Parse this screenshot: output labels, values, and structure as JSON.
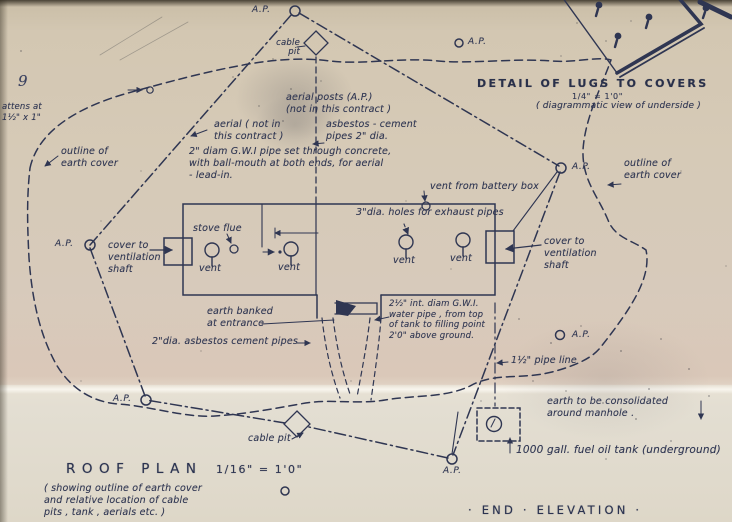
{
  "drawing": {
    "page_number": "9",
    "title": "ROOF  PLAN",
    "scale": "1/16\" = 1'0\"",
    "subtitle": "( showing outline of earth cover\nand relative location of cable\npits , tank , aerials etc. )",
    "end_elevation": "· END · ELEVATION ·"
  },
  "detail": {
    "title": "DETAIL OF LUGS TO COVERS",
    "scale": "1/4\" = 1'0\"",
    "subtitle": "( diagrammatic view of underside )"
  },
  "labels": {
    "ap": "A.P.",
    "aerial_posts": "aerial posts (A.P.)\n(not in this contract )",
    "battens": "attens at\n1½\" x 1\"",
    "outline_earth_cover": "outline of\nearth cover",
    "aerial_note": "aerial ( not in\nthis contract )",
    "asbestos_cement_pipes": "asbestos - cement\npipes  2\" dia.",
    "gwi_pipe": "2\" diam G.W.I pipe set through concrete,\nwith ball-mouth at both ends, for aerial\n- lead-in.",
    "cable_pit_top": "cable\npit",
    "cable_pit_bottom": "cable pit",
    "vent_battery_box": "vent from battery box",
    "exhaust_holes": "3\"dia. holes for exhaust pipes",
    "stove_flue": "stove flue",
    "vent": "vent",
    "cover_ventilation_shaft": "cover to\nventilation\nshaft",
    "earth_banked": "earth banked\nat entrance",
    "water_pipe": "2½\" int. diam G.W.I.\nwater pipe , from top\nof tank to filling point\n2'0\" above ground.",
    "asbestos_cement_pipes_2": "2\"dia. asbestos cement pipes",
    "pipe_line": "1½\" pipe line",
    "earth_consolidated": "earth to be consolidated\naround manhole .",
    "fuel_tank": "1000 gall. fuel oil tank (underground)"
  },
  "colors": {
    "ink": "#2f3652",
    "paper": "#d6cab7"
  }
}
